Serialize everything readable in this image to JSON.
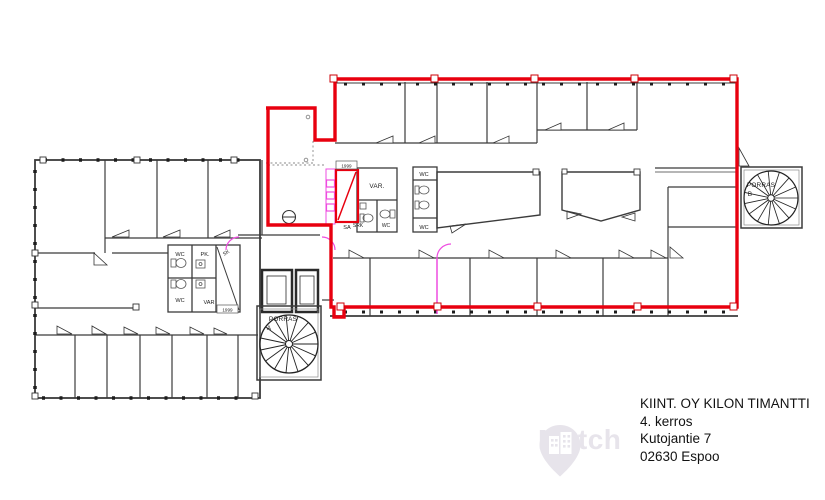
{
  "title_block": {
    "line1": "KIINT. OY KILON TIMANTTI",
    "line2": "4. kerros",
    "line3": "Kutojantie 7",
    "line4": "02630 Espoo"
  },
  "watermark": {
    "text": "Match"
  },
  "plan_labels": {
    "wc": "WC",
    "var_abbr": "VAR.",
    "var_short": "VAR",
    "pk": "PK.",
    "sk": "SK",
    "srk": "SRK",
    "sa": "SA",
    "porras": "PORRAS",
    "stair_a_letter": "A",
    "stair_b_letter": "B",
    "room_tag_1": "1999",
    "room_tag_2": "1999"
  },
  "colors": {
    "highlight_red": "#e8000f",
    "modification_pink": "#ee4ce0",
    "wall_dark": "#3b3b3b"
  }
}
